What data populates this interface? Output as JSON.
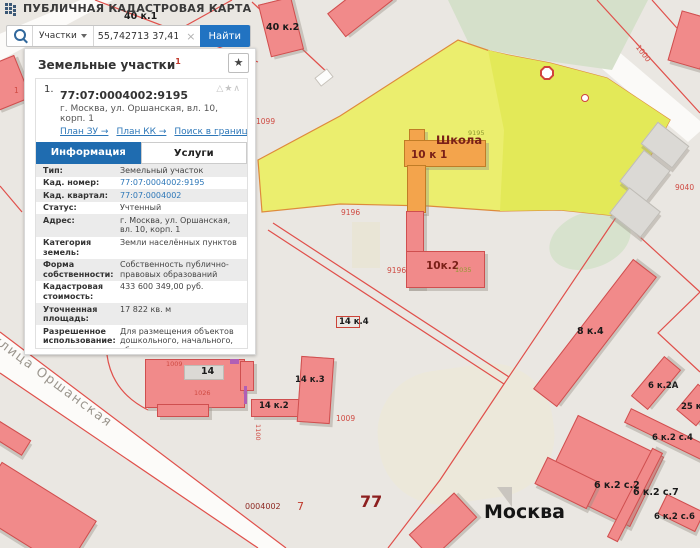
{
  "header": {
    "title": "ПУБЛИЧНАЯ КАДАСТРОВАЯ КАРТА"
  },
  "icons": {
    "clear": "×",
    "star": "★",
    "triangle": "△",
    "star_small": "★",
    "collapse": "∧"
  },
  "search": {
    "category": "Участки",
    "query": "55,742713 37,411077",
    "find_label": "Найти"
  },
  "panel": {
    "title": "Земельные участки",
    "title_sup": "1",
    "item": {
      "index": "1.",
      "cad_number": "77:07:0004002:9195",
      "address": "г. Москва, ул. Оршанская, вл. 10, корп. 1",
      "links": [
        "План ЗУ →",
        "План КК →",
        "Поиск в границах объекта →"
      ],
      "tabs": [
        "Информация",
        "Услуги"
      ],
      "rows": [
        {
          "label": "Тип:",
          "value": "Земельный участок",
          "link": false
        },
        {
          "label": "Кад. номер:",
          "value": "77:07:0004002:9195",
          "link": true
        },
        {
          "label": "Кад. квартал:",
          "value": "77:07:0004002",
          "link": true
        },
        {
          "label": "Статус:",
          "value": "Учтенный",
          "link": false
        },
        {
          "label": "Адрес:",
          "value": "г. Москва, ул. Оршанская, вл. 10, корп. 1",
          "link": false
        },
        {
          "label": "Категория земель:",
          "value": "Земли населённых пунктов",
          "link": false
        },
        {
          "label": "Форма собственности:",
          "value": "Собственность публично-правовых образований",
          "link": false
        },
        {
          "label": "Кадастровая стоимость:",
          "value": "433 600 349,00 руб.",
          "link": false
        },
        {
          "label": "Уточненная площадь:",
          "value": "17 822 кв. м",
          "link": false
        },
        {
          "label": "Разрешенное использование:",
          "value": "Для размещения объектов дошкольного, начального, общего и среднего (полного) общего образования",
          "link": false
        },
        {
          "label": "по документу:",
          "value": "объекты размещения учреждений начального и среднего общего образования (1.2.17)",
          "link": false
        },
        {
          "label": "Кадастровый инженер:",
          "value": "Субботина Людмила Владимировна",
          "link": false
        },
        {
          "label": "Дата постановки на учет:",
          "value": "13.09.2013",
          "link": false
        },
        {
          "label": "Дата изменения сведений в ГКН:",
          "value": "25.12.2017",
          "link": false
        },
        {
          "label": "Дата выгрузки сведений из ГКН:",
          "value": "25.12.2017",
          "link": false
        }
      ]
    }
  },
  "map": {
    "selected_parcel": "77:07:0004002:9195",
    "labels": [
      {
        "text": "40 к.1",
        "x": 124,
        "y": 11,
        "cls": "bld-label"
      },
      {
        "text": "40 к.2",
        "x": 266,
        "y": 22,
        "cls": "bld-label"
      },
      {
        "text": "1",
        "x": 14,
        "y": 86,
        "cls": "red-label"
      },
      {
        "text": "1099",
        "x": 256,
        "y": 117,
        "cls": "red-label"
      },
      {
        "text": "Школа",
        "x": 436,
        "y": 133,
        "cls": "school"
      },
      {
        "text": "10 к 1",
        "x": 411,
        "y": 149,
        "cls": "maroon"
      },
      {
        "text": "9195",
        "x": 468,
        "y": 129,
        "cls": "olive"
      },
      {
        "text": "1000",
        "x": 641,
        "y": 43,
        "cls": "red-label",
        "rot": 52
      },
      {
        "text": "9040",
        "x": 675,
        "y": 183,
        "cls": "red-label"
      },
      {
        "text": "9196",
        "x": 341,
        "y": 208,
        "cls": "red-label"
      },
      {
        "text": "9196",
        "x": 387,
        "y": 266,
        "cls": "red-label"
      },
      {
        "text": "10к.2",
        "x": 426,
        "y": 260,
        "cls": "maroon"
      },
      {
        "text": "1035",
        "x": 455,
        "y": 266,
        "cls": "olive"
      },
      {
        "text": "14 к.4",
        "x": 339,
        "y": 317,
        "cls": "bld-label-sm"
      },
      {
        "text": "8 к.4",
        "x": 577,
        "y": 326,
        "cls": "bld-label"
      },
      {
        "text": "14",
        "x": 201,
        "y": 366,
        "cls": "bld-label"
      },
      {
        "text": "1009",
        "x": 166,
        "y": 360,
        "cls": "red-sm"
      },
      {
        "text": "1026",
        "x": 194,
        "y": 389,
        "cls": "red-sm"
      },
      {
        "text": "14 к.2",
        "x": 259,
        "y": 401,
        "cls": "bld-label-sm"
      },
      {
        "text": "14 к.3",
        "x": 295,
        "y": 375,
        "cls": "bld-label-sm"
      },
      {
        "text": "1100",
        "x": 262,
        "y": 424,
        "cls": "red-sm",
        "rot": 90
      },
      {
        "text": "1009",
        "x": 336,
        "y": 414,
        "cls": "red-label"
      },
      {
        "text": "6 к.2А",
        "x": 648,
        "y": 381,
        "cls": "bld-label-sm"
      },
      {
        "text": "25 к",
        "x": 681,
        "y": 402,
        "cls": "bld-label-sm"
      },
      {
        "text": "6 к.2 с.4",
        "x": 652,
        "y": 433,
        "cls": "bld-label-sm"
      },
      {
        "text": "6 к.2 с.2",
        "x": 594,
        "y": 480,
        "cls": "bld-label"
      },
      {
        "text": "6 к.2 с.7",
        "x": 633,
        "y": 487,
        "cls": "bld-label"
      },
      {
        "text": "6 к.2 с.6",
        "x": 654,
        "y": 512,
        "cls": "bld-label-sm"
      },
      {
        "text": "0004002",
        "x": 245,
        "y": 502,
        "cls": "darkred-label"
      },
      {
        "text": "7",
        "x": 297,
        "y": 500,
        "cls": "red-md"
      },
      {
        "text": "77",
        "x": 360,
        "y": 492,
        "cls": "quarter-label"
      },
      {
        "text": "Москва",
        "x": 484,
        "y": 501,
        "cls": "city-label"
      },
      {
        "text": "улица Оршанская",
        "x": -2,
        "y": 332,
        "cls": "street-label",
        "rot": 36.5
      }
    ]
  },
  "colors": {
    "selected_parcel_fill": "#ebee6e",
    "selected_parcel_fill_dark": "#e3e958",
    "building_fill": "#f18a8a",
    "school_fill": "#f3a44c",
    "boundary_line": "#e0504b",
    "accent_blue": "#2173c2",
    "tab_active": "#1f6cb0"
  }
}
